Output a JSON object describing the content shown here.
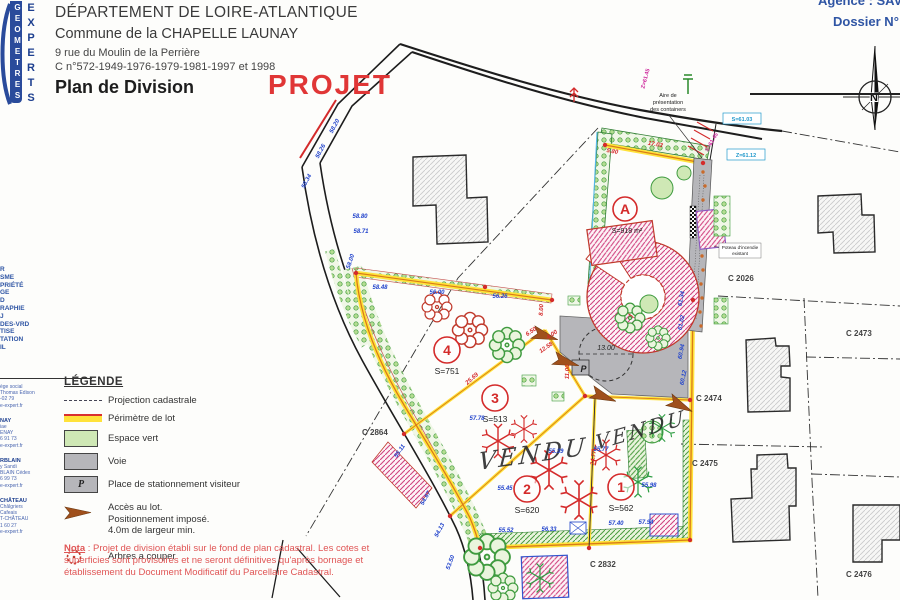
{
  "header": {
    "departement": "DÉPARTEMENT DE LOIRE-ATLANTIQUE",
    "commune": "Commune de la CHAPELLE LAUNAY",
    "adresse": "9 rue du Moulin de la Perrière",
    "reference": "C n°572-1949-1976-1979-1981-1997 et 1998",
    "titre": "Plan de Division",
    "tampon": "PROJET"
  },
  "dossier": {
    "agence": "Agence : SAVE",
    "numero": "Dossier N° : S"
  },
  "logo": {
    "geometres": "GEOMETRES",
    "experts": "EXPERTS"
  },
  "sidebar": {
    "services": [
      "R",
      "SME",
      "PRIÉTÉ",
      "GE",
      "D",
      "RAPHIE",
      "J",
      "DES-VRD",
      "TISE",
      "TATION",
      "IL"
    ],
    "offices": [
      {
        "title": "",
        "lines": [
          "ège social",
          "Thomas Edison",
          "-02 79",
          "e-expert.fr"
        ]
      },
      {
        "title": "NAY",
        "lines": [
          "iae",
          "ENAY",
          "6 91 73",
          "e-expert.fr"
        ]
      },
      {
        "title": "RBLAIN",
        "lines": [
          "y Sandi",
          "BLAIN Cédex",
          "6 99 73",
          "e-expert.fr"
        ]
      },
      {
        "title": "CHÂTEAU",
        "lines": [
          "Châlgriers",
          "Cafeais",
          "T-CHÂTEAU",
          "1 60 27",
          "e-expert.fr"
        ]
      }
    ]
  },
  "legend": {
    "title": "LÉGENDE",
    "projection": "Projection cadastrale",
    "perimetre": "Périmètre de lot",
    "espace_vert": "Espace vert",
    "voie": "Voie",
    "stationnement": "Place de stationnement visiteur",
    "acces": [
      "Accès au lot.",
      "Positionnement imposé.",
      "4.0m de largeur min."
    ],
    "arbres": "Arbres a couper",
    "p": "P"
  },
  "nota": {
    "label": "Nota",
    "text": " : Projet de division établi sur le fond de plan cadastral. Les cotes et superficies sont provisoires et ne seront définitives qu'après bornage et établissement du Document Modificatif du Parcellaire Cadastral."
  },
  "plan": {
    "lots": [
      {
        "id": "A",
        "surface": "S=918 m²"
      },
      {
        "id": "4",
        "surface": "S=751"
      },
      {
        "id": "3",
        "surface": "S=513"
      },
      {
        "id": "2",
        "surface": "S=620"
      },
      {
        "id": "1",
        "surface": "S=562"
      }
    ],
    "vendu": "VENDU",
    "parcelles": [
      "C 2026",
      "C 2473",
      "C 2474",
      "C 2475",
      "C 2476",
      "C 2832",
      "C 2864"
    ],
    "containers": [
      "Aire de",
      "présentation",
      "des containers"
    ],
    "hydrant": [
      "Poteau d'incendie",
      "existant"
    ],
    "rayon": "13.00",
    "p": "P",
    "nord": "N",
    "cotes": [
      {
        "v": "25.69"
      },
      {
        "v": "34.77"
      },
      {
        "v": "17.03"
      },
      {
        "v": "6.50"
      },
      {
        "v": "4.00"
      },
      {
        "v": "12.58"
      },
      {
        "v": "11.00"
      },
      {
        "v": "8.00"
      },
      {
        "v": "5.80"
      }
    ],
    "niveaux": [
      {
        "v": "58.26"
      },
      {
        "v": "58.34"
      },
      {
        "v": "58.20"
      },
      {
        "v": "58.80"
      },
      {
        "v": "58.71"
      },
      {
        "v": "58.48"
      },
      {
        "v": "56.00"
      },
      {
        "v": "57.78"
      },
      {
        "v": "55.45"
      },
      {
        "v": "55.39"
      },
      {
        "v": "55.77"
      },
      {
        "v": "55.98"
      },
      {
        "v": "55.52"
      },
      {
        "v": "56.33"
      },
      {
        "v": "57.40"
      },
      {
        "v": "57.94"
      },
      {
        "v": "61.34"
      },
      {
        "v": "61.02"
      },
      {
        "v": "60.94"
      },
      {
        "v": "60.12"
      },
      {
        "v": "55.11"
      },
      {
        "v": "54.67"
      },
      {
        "v": "54.13"
      },
      {
        "v": "53.50"
      },
      {
        "v": "58.00"
      },
      {
        "v": "56.26"
      }
    ],
    "reperes": [
      {
        "v": "Z=61.45"
      },
      {
        "v": "S=61.03"
      },
      {
        "v": "Z=61.12"
      },
      {
        "v": "S=61.45"
      }
    ]
  },
  "colors": {
    "accent_red": "#e03636",
    "perimeter_yellow": "#ffe23a",
    "perimeter_orange": "#d97b18",
    "espace_vert": "#cfe8b5",
    "voie_gray": "#b6b6ba",
    "blue_text": "#2f55a4",
    "hatch_pink": "#d1437f"
  }
}
